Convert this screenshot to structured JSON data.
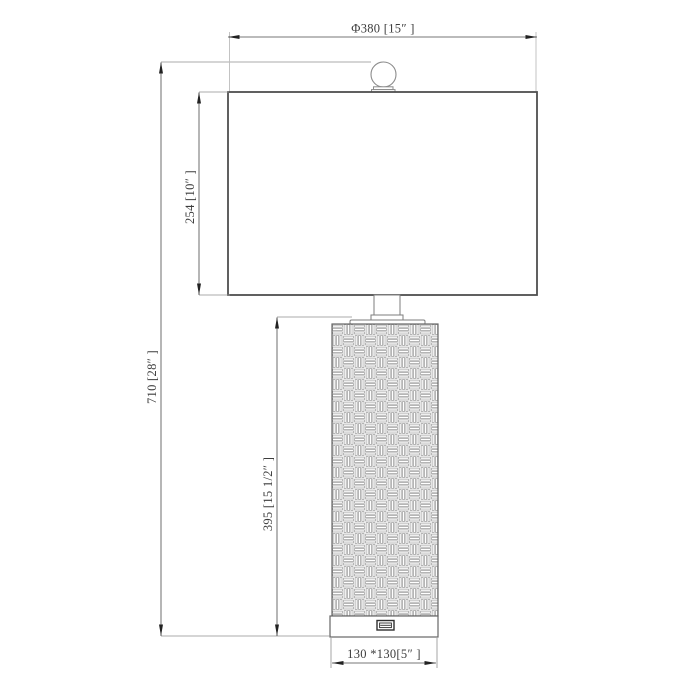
{
  "drawing": {
    "labels": {
      "shade_diameter": "Φ380 [15″  ]",
      "shade_height": "254 [10″  ]",
      "overall_height": "710 [28″  ]",
      "body_height": "395 [15 1/2″  ]",
      "base_size": "130 *130[5″  ]"
    },
    "values": {
      "shade_diameter_mm": 380,
      "shade_diameter_in": "15",
      "shade_height_mm": 254,
      "shade_height_in": "10",
      "overall_height_mm": 710,
      "overall_height_in": "28",
      "body_height_mm": 395,
      "body_height_in": "15 1/2",
      "base_size_mm": "130 x 130",
      "base_size_in": "5"
    },
    "colors": {
      "background": "#ffffff",
      "outline": "#6a6a6a",
      "dimension": "#4a4a4a",
      "weave_pattern": "#979797",
      "text": "#3d3d3d"
    }
  }
}
